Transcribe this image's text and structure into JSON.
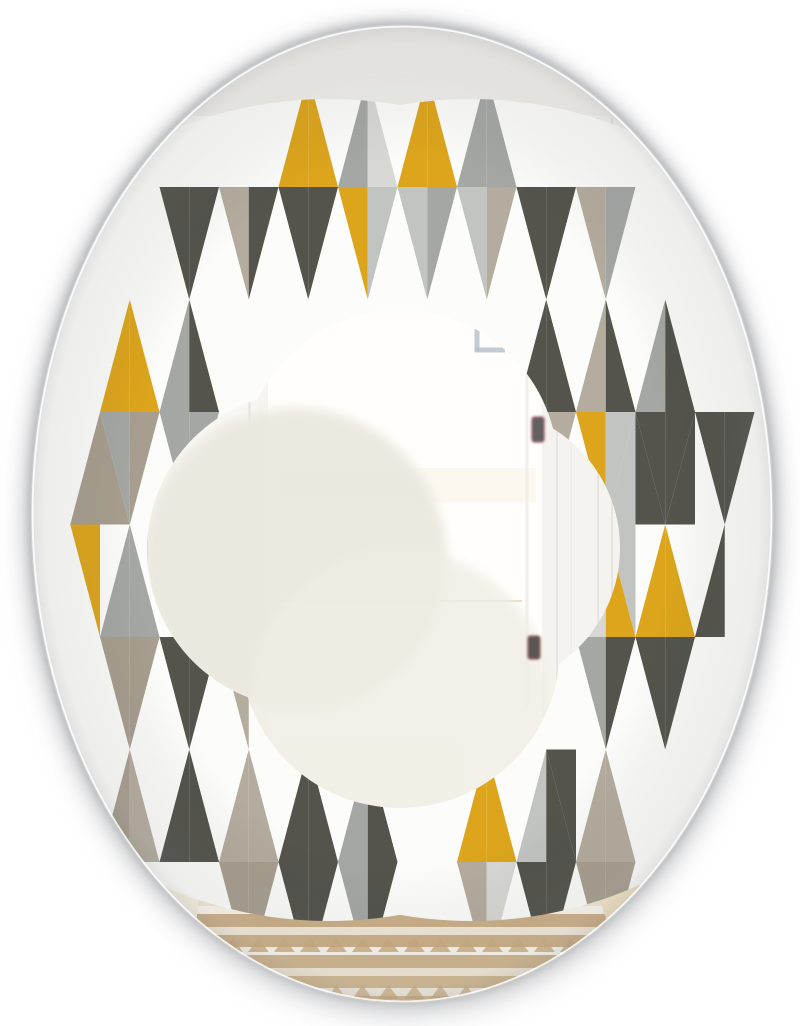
{
  "canvas": {
    "w": 800,
    "h": 1026,
    "bg": "#ffffff"
  },
  "mirror": {
    "cx": 402,
    "cy": 514,
    "rx": 371,
    "ry": 489,
    "edge_outer": "#c9cdd1",
    "edge_inner": "#ffffff",
    "base_fill": "#f6f5f1",
    "shadows": [
      {
        "cx": 402,
        "cy": 512,
        "rx": 374,
        "ry": 491,
        "f": "#7d7e83",
        "o": 0.35,
        "blur": "b6"
      },
      {
        "cx": 402,
        "cy": 514,
        "rx": 377,
        "ry": 494,
        "f": "#8f9094",
        "o": 0.4,
        "blur": "b14"
      },
      {
        "cx": 402,
        "cy": 524,
        "rx": 378,
        "ry": 496,
        "f": "#a6a7ab",
        "o": 0.3,
        "blur": "b22"
      }
    ]
  },
  "pattern": {
    "ring_base": "#fcfcfa",
    "palette": {
      "W": "#fcfcfa",
      "C": "#54544d",
      "G": "#a5a7a5",
      "L": "#c2c4c2",
      "P": "#d7d7d4",
      "T": "#b4ac9e",
      "D": "#a79e8f",
      "Y": "#dca51c"
    },
    "grid": {
      "x0": 100,
      "dx": 29.75,
      "halfW": 29.75,
      "halfH": 112.5
    },
    "outer_circles": [
      {
        "cx": 400,
        "cy": 416,
        "r": 296
      },
      {
        "cx": 400,
        "cy": 641,
        "r": 274
      },
      {
        "cx": 471,
        "cy": 510,
        "r": 411
      },
      {
        "cx": 329,
        "cy": 510,
        "r": 411
      }
    ],
    "inner_lobes": [
      {
        "cx": 400,
        "cy": 468,
        "r": 158
      },
      {
        "cx": 400,
        "cy": 648,
        "r": 160
      },
      {
        "cx": 305,
        "cy": 550,
        "r": 158
      },
      {
        "cx": 480,
        "cy": 548,
        "r": 140
      }
    ],
    "cells": [
      {
        "m": 0,
        "cy": 524.5,
        "q": "DDYW"
      },
      {
        "m": 1,
        "cy": 412,
        "q": "YYGD"
      },
      {
        "m": 1,
        "cy": 637,
        "q": "GGDD"
      },
      {
        "m": 1,
        "cy": 862,
        "q": "DTWW"
      },
      {
        "m": 3,
        "cy": 187,
        "q": "WWCC"
      },
      {
        "m": 3,
        "cy": 412,
        "q": "GCGG"
      },
      {
        "m": 3,
        "cy": 637,
        "q": "WWCC"
      },
      {
        "m": 3,
        "cy": 862,
        "q": "CCWW"
      },
      {
        "m": 5,
        "cy": 187,
        "q": "WWTC"
      },
      {
        "m": 5,
        "cy": 637,
        "q": "WWTW"
      },
      {
        "m": 5,
        "cy": 862,
        "q": "TTDD"
      },
      {
        "m": 7,
        "cy": 187,
        "q": "YYCC"
      },
      {
        "m": 7,
        "cy": 862,
        "q": "CCCC"
      },
      {
        "m": 9,
        "cy": 187,
        "q": "GPYL"
      },
      {
        "m": 9,
        "cy": 862,
        "q": "GCGC"
      },
      {
        "m": 11,
        "cy": 187,
        "q": "YYLG"
      },
      {
        "m": 13,
        "cy": 187,
        "q": "GGLT"
      },
      {
        "m": 13,
        "cy": 862,
        "q": "YYTP"
      },
      {
        "m": 15,
        "cy": 187,
        "q": "WWCC"
      },
      {
        "m": 15,
        "cy": 412,
        "q": "CCGT"
      },
      {
        "m": 15,
        "cy": 862,
        "q": "LCCC"
      },
      {
        "m": 16,
        "cy": 749.5,
        "q": "WWCW"
      },
      {
        "m": 17,
        "cy": 187,
        "q": "WWTG"
      },
      {
        "m": 17,
        "cy": 412,
        "q": "TCYL"
      },
      {
        "m": 17,
        "cy": 637,
        "q": "PYGC"
      },
      {
        "m": 17,
        "cy": 862,
        "q": "TTDD"
      },
      {
        "m": 18,
        "cy": 524.5,
        "q": "LCLW"
      },
      {
        "m": 19,
        "cy": 412,
        "q": "GCCC"
      },
      {
        "m": 19,
        "cy": 637,
        "q": "YYCC"
      },
      {
        "m": 20,
        "cy": 524.5,
        "q": "CWWW"
      },
      {
        "m": 21,
        "cy": 412,
        "q": "WWCC"
      },
      {
        "m": 21,
        "cy": 637,
        "q": "CWWW"
      }
    ]
  },
  "reflection": {
    "layers": [
      {
        "n": "wall-base",
        "t": "rect",
        "x": 28,
        "y": 20,
        "w": 750,
        "h": 1000,
        "f": "#f6f5f1"
      },
      {
        "n": "upper-wall",
        "t": "rect",
        "x": 28,
        "y": 20,
        "w": 750,
        "h": 102,
        "f": "#efeeea"
      },
      {
        "n": "left-wall",
        "t": "rect",
        "x": 28,
        "y": 116,
        "w": 230,
        "h": 570,
        "f": "#f8f7f4"
      },
      {
        "n": "left-wall-seam",
        "t": "line",
        "x1": 34,
        "y1": 228,
        "x2": 252,
        "y2": 228,
        "s": "#e4e2dd",
        "w": 2.5
      },
      {
        "n": "right-wall",
        "t": "rect",
        "x": 540,
        "y": 116,
        "w": 238,
        "h": 620,
        "f": "#f4f3ef"
      },
      {
        "n": "window-molding",
        "t": "rect",
        "x": 60,
        "y": 98,
        "w": 1,
        "h": 560,
        "f": "#fcfbf9",
        "s": "#e7e4df"
      },
      {
        "n": "window-molding",
        "t": "rect",
        "x": 95,
        "y": 128,
        "w": 1,
        "h": 525,
        "f": "#fbfaf8",
        "s": "#e7e4df"
      },
      {
        "n": "window-molding",
        "t": "rect",
        "x": 133,
        "y": 175,
        "w": 1,
        "h": 478,
        "f": "#fcfbf9",
        "s": "#e9e6e1"
      },
      {
        "n": "window-bar",
        "t": "rect",
        "x": 95,
        "y": 298,
        "w": 60,
        "h": 7,
        "f": "#e9e7e2"
      },
      {
        "n": "window-bar",
        "t": "rect",
        "x": 95,
        "y": 343,
        "w": 60,
        "h": 7,
        "f": "#e9e7e2"
      },
      {
        "n": "window-bar",
        "t": "rect",
        "x": 95,
        "y": 389,
        "w": 60,
        "h": 7,
        "f": "#e9e7e2"
      },
      {
        "n": "window-bar",
        "t": "rect",
        "x": 95,
        "y": 436,
        "w": 60,
        "h": 7,
        "f": "#e9e7e2"
      },
      {
        "n": "window-latch",
        "t": "rect",
        "x": 77,
        "y": 356,
        "w": 13,
        "h": 32,
        "f": "#c6c6c4"
      },
      {
        "n": "magenta-fringe",
        "t": "line",
        "x1": 58,
        "y1": 330,
        "x2": 58,
        "y2": 562,
        "s": "#bb3f8e",
        "w": 1.6,
        "o": 0.85
      },
      {
        "n": "magenta-fringe",
        "t": "line",
        "x1": 87,
        "y1": 108,
        "x2": 87,
        "y2": 330,
        "s": "#bb3f8e",
        "w": 1.6,
        "o": 0.85
      },
      {
        "n": "magenta-fringe",
        "t": "line",
        "x1": 108,
        "y1": 150,
        "x2": 108,
        "y2": 425,
        "s": "#b0307a",
        "w": 1.4,
        "o": 0.8
      },
      {
        "n": "magenta-fringe",
        "t": "line",
        "x1": 129,
        "y1": 232,
        "x2": 129,
        "y2": 642,
        "s": "#bb3f8e",
        "w": 1.8,
        "o": 0.85
      },
      {
        "n": "magenta-fringe",
        "t": "line",
        "x1": 147,
        "y1": 434,
        "x2": 147,
        "y2": 652,
        "s": "#b0307a",
        "w": 1.4,
        "o": 0.8
      },
      {
        "n": "doorframe-left",
        "t": "rect",
        "x": 249,
        "y": 112,
        "w": 1,
        "h": 800,
        "f": "#fefefc",
        "s": "#e5e3de"
      },
      {
        "n": "doorway-bright",
        "t": "rect",
        "x": 268,
        "y": 114,
        "w": 274,
        "h": 798,
        "f": "#fffefc"
      },
      {
        "n": "doorway-tint",
        "t": "rect",
        "x": 280,
        "y": 468,
        "w": 256,
        "h": 34,
        "f": "#faf3e6",
        "o": 0.55
      },
      {
        "n": "doorway-line",
        "t": "line",
        "x1": 280,
        "y1": 601,
        "x2": 522,
        "y2": 601,
        "s": "#e6d6bf",
        "w": 2,
        "o": 0.8
      },
      {
        "n": "doorway-tint",
        "t": "rect",
        "x": 278,
        "y": 742,
        "w": 180,
        "h": 140,
        "f": "#f8f0e1",
        "o": 0.35
      },
      {
        "n": "door-edge",
        "t": "line",
        "x1": 527,
        "y1": 300,
        "x2": 527,
        "y2": 706,
        "s": "#efece6",
        "w": 3,
        "o": 0.8
      },
      {
        "n": "right-frame",
        "t": "line",
        "x1": 557,
        "y1": 120,
        "x2": 557,
        "y2": 700,
        "s": "#e8e6e2",
        "w": 2
      },
      {
        "n": "right-frame",
        "t": "line",
        "x1": 571,
        "y1": 120,
        "x2": 571,
        "y2": 690,
        "s": "#eceae6",
        "w": 1.2
      },
      {
        "n": "right-frame",
        "t": "line",
        "x1": 598,
        "y1": 118,
        "x2": 598,
        "y2": 660,
        "s": "#e6e4e0",
        "w": 2
      },
      {
        "n": "right-frame",
        "t": "line",
        "x1": 612,
        "y1": 118,
        "x2": 612,
        "y2": 655,
        "s": "#dedcd7",
        "w": 1.2
      },
      {
        "n": "right-frame",
        "t": "line",
        "x1": 692,
        "y1": 60,
        "x2": 692,
        "y2": 560,
        "s": "#e9e7e3",
        "w": 2
      },
      {
        "n": "right-frame",
        "t": "line",
        "x1": 706,
        "y1": 60,
        "x2": 706,
        "y2": 600,
        "s": "#eeedea",
        "w": 1.2
      },
      {
        "n": "blue-strip",
        "t": "rect",
        "x": 714,
        "y": 240,
        "w": 34,
        "h": 560,
        "f": "#e9edf1",
        "o": 0.7,
        "blur": "b8"
      },
      {
        "n": "frame-corner",
        "t": "line",
        "x1": 477,
        "y1": 292,
        "x2": 477,
        "y2": 352,
        "s": "#b9c4cc",
        "w": 5,
        "o": 0.85
      },
      {
        "n": "frame-corner",
        "t": "line",
        "x1": 475,
        "y1": 350,
        "x2": 505,
        "y2": 350,
        "s": "#b9c4cc",
        "w": 5,
        "o": 0.85
      },
      {
        "n": "cream-lobe",
        "t": "circle",
        "cx": 295,
        "cy": 560,
        "r": 152,
        "f": "#ebe8df",
        "o": 0.95,
        "blur": "b8"
      },
      {
        "n": "cream-lobe",
        "t": "circle",
        "cx": 400,
        "cy": 700,
        "r": 150,
        "f": "#f0ede4",
        "o": 0.8,
        "blur": "b8"
      },
      {
        "n": "left-floor",
        "t": "poly",
        "p": "28,650 252,898 252,1020 28,1020",
        "f": "#f6f0e1"
      },
      {
        "n": "floor-seam",
        "t": "line",
        "x1": 30,
        "y1": 652,
        "x2": 252,
        "y2": 898,
        "s": "#eae5d8",
        "w": 3
      },
      {
        "n": "center-floor",
        "t": "rect",
        "x": 250,
        "y": 893,
        "w": 292,
        "h": 130,
        "f": "#f3e9d3"
      },
      {
        "n": "right-floor",
        "t": "poly",
        "p": "540,912 778,630 778,1020 540,1020",
        "f": "#f1e3c6"
      },
      {
        "n": "floor-seam",
        "t": "line",
        "x1": 540,
        "y1": 910,
        "x2": 775,
        "y2": 633,
        "s": "#e9dfcb",
        "w": 3
      },
      {
        "n": "wood-patch",
        "t": "poly",
        "p": "600,1020 680,940 778,940 778,1020",
        "f": "#eddcb8",
        "o": 0.7
      }
    ],
    "rug": {
      "outline": "205,855 585,855 640,1022 183,1022",
      "base": "#ece2cc",
      "fringe": {
        "y": 846,
        "h": 16,
        "x1": 206,
        "x2": 586,
        "step": 9,
        "w": 3.5,
        "c": "#c2a377"
      },
      "stripes": [
        {
          "y": 866,
          "h": 11,
          "c": "#cfb590"
        },
        {
          "y": 877,
          "h": 7,
          "c": "#f2ebdb"
        },
        {
          "y": 884,
          "h": 13,
          "c": "#c9ad85"
        },
        {
          "y": 897,
          "h": 9,
          "c": "#efe7d5"
        },
        {
          "y": 906,
          "h": 8,
          "c": "#fbf7ee"
        },
        {
          "y": 914,
          "h": 13,
          "c": "#cbb08a"
        },
        {
          "y": 927,
          "h": 8,
          "c": "#f1e9d8"
        },
        {
          "y": 935,
          "h": 12,
          "c": "#ccb18b"
        },
        {
          "y": 947,
          "h": 8,
          "c": "#faf6ec"
        },
        {
          "y": 955,
          "h": 13,
          "c": "#cfb690"
        },
        {
          "y": 968,
          "h": 8,
          "c": "#f0e8d6"
        },
        {
          "y": 976,
          "h": 12,
          "c": "#d2ba94"
        },
        {
          "y": 988,
          "h": 8,
          "c": "#f4eedf"
        },
        {
          "y": 996,
          "h": 26,
          "c": "#d5bd98"
        }
      ],
      "tri_rows": [
        {
          "y": 938,
          "h": 14,
          "step": 26,
          "c": "#c9ab80",
          "o": 0.8
        },
        {
          "y": 985,
          "h": 14,
          "step": 26,
          "c": "#c9ab80",
          "o": 0.7
        }
      ]
    },
    "hinges": [
      {
        "x": 542,
        "y": 194,
        "w": 11,
        "h": 27,
        "f": "#56544f",
        "s": "#9c4044"
      },
      {
        "x": 606,
        "y": 190,
        "w": 9,
        "h": 25,
        "f": "#464643",
        "s": "#8d3a3f"
      },
      {
        "x": 532,
        "y": 417,
        "w": 12,
        "h": 25,
        "f": "#5b5a55",
        "s": "#8e3a44"
      },
      {
        "x": 528,
        "y": 636,
        "w": 12,
        "h": 23,
        "f": "#524f4b",
        "s": "#8a3a40"
      }
    ],
    "hooks": {
      "color": "#241b15",
      "items": [
        {
          "x": 628,
          "y": 506
        },
        {
          "x": 689,
          "y": 504
        },
        {
          "x": 690,
          "y": 689
        },
        {
          "x": 692,
          "y": 733
        },
        {
          "x": 687,
          "y": 796
        },
        {
          "x": 655,
          "y": 825
        }
      ],
      "smudge": {
        "cx": 736,
        "cy": 577,
        "r": 8,
        "f": "#6b6257",
        "o": 0.5
      }
    }
  }
}
